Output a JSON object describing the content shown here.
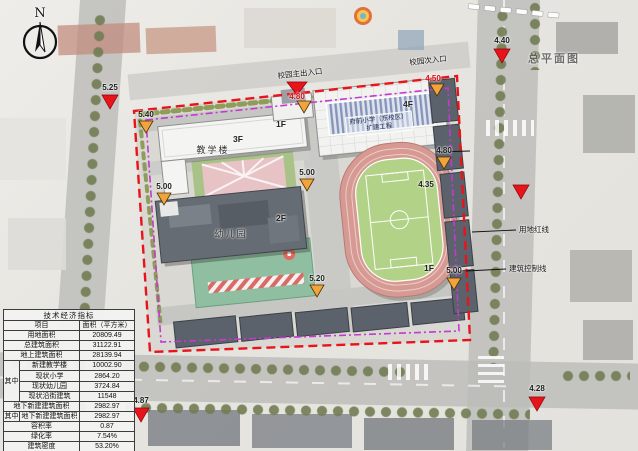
{
  "compass": {
    "label": "N"
  },
  "watermark": "总平面图",
  "entrances": {
    "main_label": "校园主出入口",
    "main_elev": "4.80",
    "secondary_label": "校园次入口",
    "secondary_elev": "4.50"
  },
  "legend_lines": {
    "red_line": "用地红线",
    "control_line": "建筑控制线"
  },
  "road_elevations": {
    "left": "5.25",
    "top_right": "4.40",
    "bottom_left": "4.87",
    "bottom_right": "4.28"
  },
  "site_elevations": {
    "nw": "5.40",
    "west": "5.00",
    "center": "5.00",
    "south": "5.20",
    "east_upper": "4.80",
    "track": "4.35",
    "east_lower": "5.00"
  },
  "buildings": {
    "teaching": "教学楼",
    "teaching_floor": "3F",
    "link_floor": "1F",
    "main_floor": "4F",
    "project_line1": "府前小学（东校区）",
    "project_line2": "扩建工程",
    "kindergarten": "幼儿园",
    "kindergarten_floor": "2F",
    "street_floor": "1F"
  },
  "colors": {
    "land_red_line": "#e8141c",
    "building_control_line": "#c439cf",
    "entrance_marker": "#f2a33c"
  },
  "table": {
    "title": "技术经济指标",
    "col_item": "项目",
    "col_area": "面积（平方米）",
    "rows_top": [
      {
        "label": "用地面积",
        "value": "20809.49"
      },
      {
        "label": "总建筑面积",
        "value": "31122.91"
      },
      {
        "label": "地上建筑面积",
        "value": "28139.94"
      }
    ],
    "among_label": "其中",
    "among_rows": [
      {
        "label": "新建教学楼",
        "value": "10002.90"
      },
      {
        "label": "现状小学",
        "value": "2864.20"
      },
      {
        "label": "现状幼儿园",
        "value": "3724.84"
      },
      {
        "label": "现状沿街建筑",
        "value": "11548"
      }
    ],
    "underground": {
      "label": "地下新建建筑面积",
      "value": "2982.97"
    },
    "among2_label": "其中",
    "among2": {
      "label": "地下新建建筑面积",
      "value": "2982.97"
    },
    "rows_bottom": [
      {
        "label": "容积率",
        "value": "0.87"
      },
      {
        "label": "绿化率",
        "value": "7.54%"
      },
      {
        "label": "建筑密度",
        "value": "53.20%"
      }
    ]
  }
}
